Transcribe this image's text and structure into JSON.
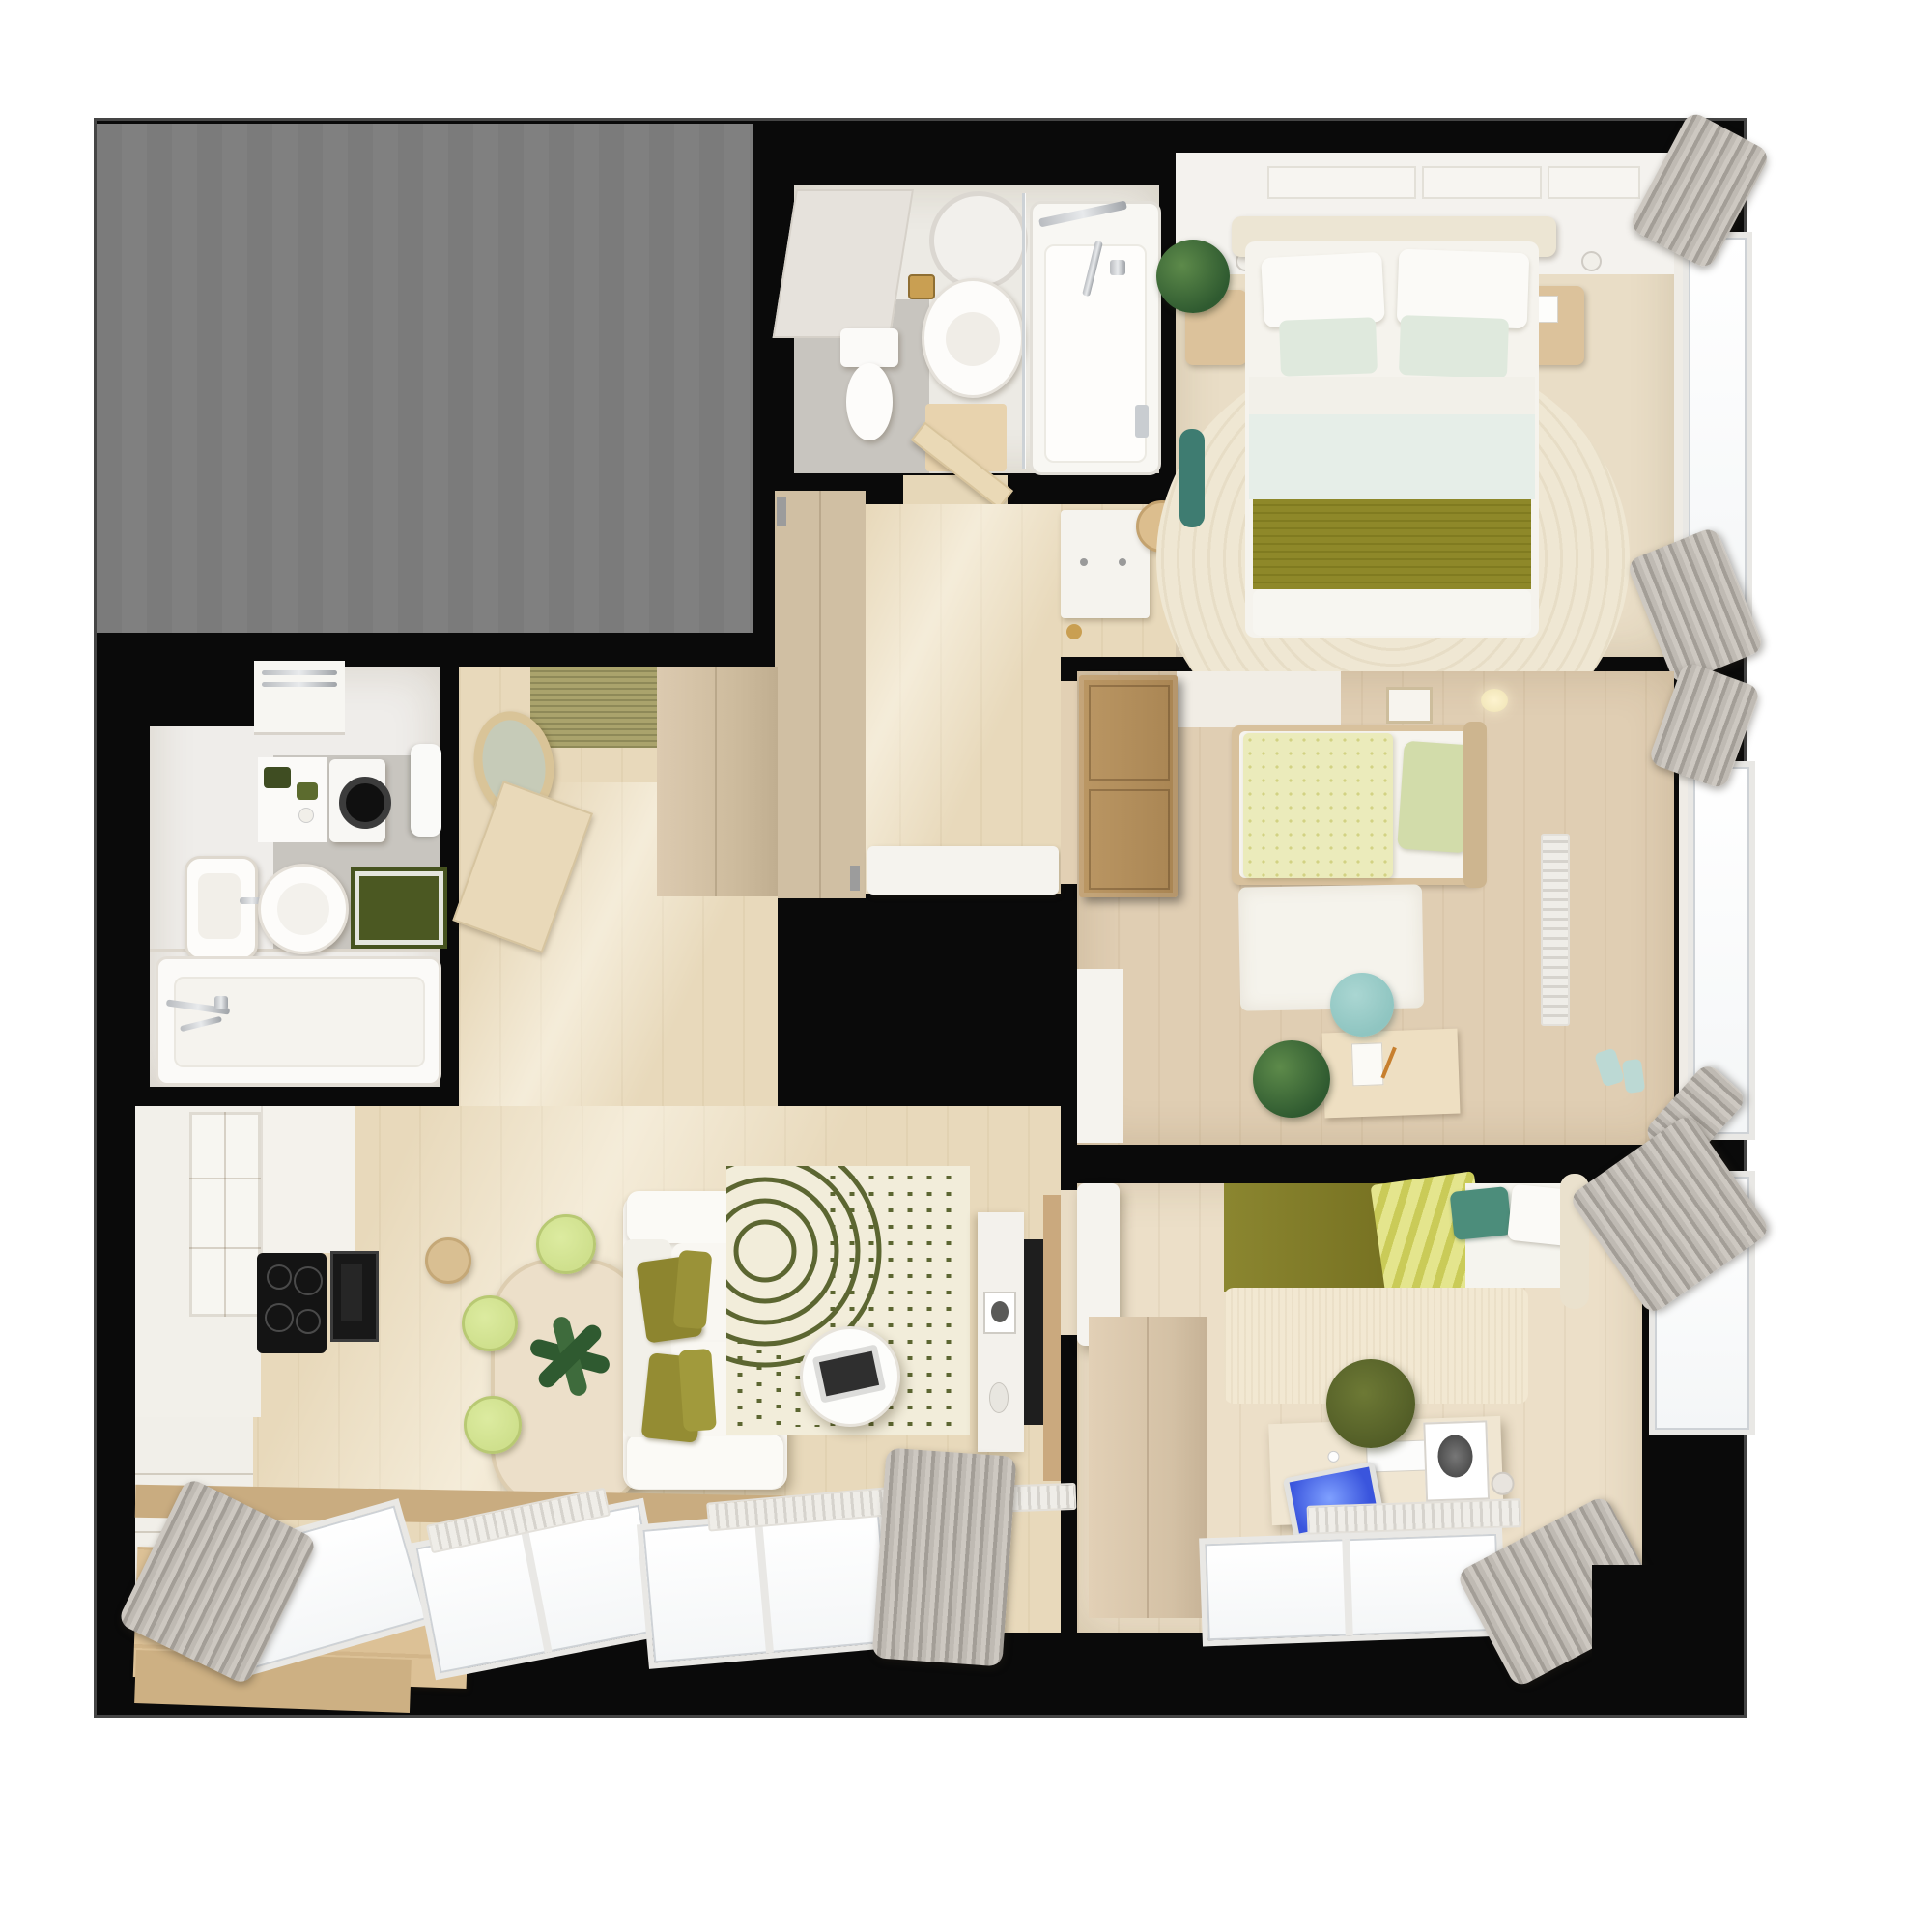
{
  "scene": {
    "kind": "apartment-floor-plan-top-down-3d-render",
    "has_text": false
  },
  "palette": {
    "page": "#ffffff",
    "wall": "#0a0a0a",
    "outline": "#454545",
    "grayarea": "#7e7e7e",
    "wood_light": "#e8d9bb",
    "wood_mid": "#e0ceb3",
    "wood_warm": "#ecdfc8",
    "wood_pale": "#e9ddc6",
    "tile_gray": "#c8c5bf",
    "tile_white": "#eceae4",
    "white_furn": "#f5f3ee",
    "wood_furn": "#dcc29b",
    "wood_door": "#b3905f",
    "olive": "#8e8829",
    "olive_dark": "#4a551f",
    "sage": "#dfe9dd",
    "lime": "#cfe08d",
    "teal": "#3e7c71",
    "teal_light": "#8fc5c1",
    "cream_rug": "#f0e8d4",
    "curtain": "#a39e97",
    "radiator": "#efede8",
    "screen_blue": "#3a55dd",
    "plant": "#2f5a30",
    "gold": "#c99f52",
    "duvet_pale": "#ebebbb",
    "bedding_blue": "#e6eee8",
    "mat_green": "#4b5822",
    "mat_entry": "#aaa36c"
  },
  "rooms": [
    {
      "id": "utility-gray-area",
      "furniture": []
    },
    {
      "id": "small-bathroom",
      "furniture": [
        "toilet",
        "vanity-sink",
        "round-mirror",
        "gold-tray",
        "shower-screen",
        "bathtub",
        "bath-mat",
        "mirror-panel"
      ]
    },
    {
      "id": "master-bedroom",
      "furniture": [
        "double-bed",
        "headboard",
        "pillows",
        "olive-blanket",
        "round-rug",
        "nightstand-left",
        "nightstand-right",
        "plant",
        "teal-bench",
        "wall-lamps",
        "wall-art",
        "window",
        "curtains",
        "white-dresser",
        "side-table"
      ]
    },
    {
      "id": "kids-bedroom",
      "furniture": [
        "single-bed",
        "dotted-duvet",
        "sage-pillow",
        "open-wood-door",
        "white-dresser",
        "rug",
        "desk",
        "teal-chair",
        "plant",
        "radiator",
        "window",
        "curtains",
        "picture-frame"
      ]
    },
    {
      "id": "third-bedroom",
      "furniture": [
        "double-bed",
        "olive-blanket",
        "striped-throw",
        "teal-pillow",
        "white-door",
        "wardrobe",
        "arch-rug",
        "desk",
        "office-chair",
        "laptop",
        "keyboard",
        "poster",
        "windows",
        "radiator",
        "curtains"
      ]
    },
    {
      "id": "main-bathroom",
      "furniture": [
        "bathtub",
        "square-sink",
        "round-sink",
        "washing-machine",
        "toilet",
        "green-mat",
        "towel-counter",
        "faucet"
      ]
    },
    {
      "id": "entry-hall",
      "furniture": [
        "oval-mirror",
        "doormat",
        "entry-wardrobe",
        "hall-closet",
        "bench",
        "bathroom-door",
        "open-door"
      ]
    },
    {
      "id": "kitchen-living-room",
      "furniture": [
        "kitchen-cabinets",
        "glass-cabinet",
        "cooktop",
        "oven",
        "wood-bench",
        "dining-table",
        "plant-centerpiece",
        "lime-chairs",
        "stool",
        "sofa",
        "olive-pillows",
        "pattern-rug",
        "coffee-table",
        "laptop",
        "tv-console",
        "tv",
        "picture-frame",
        "windows",
        "radiators",
        "curtains"
      ]
    }
  ]
}
